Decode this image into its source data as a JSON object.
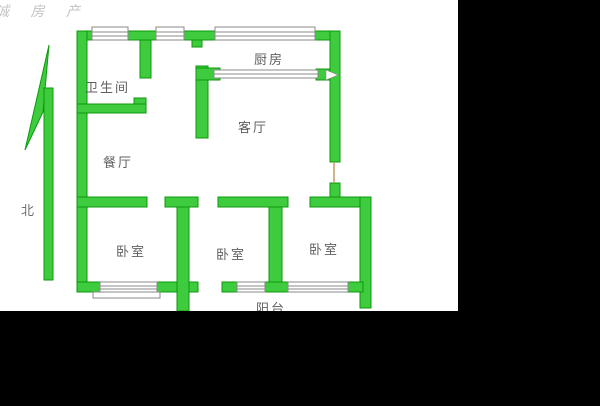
{
  "watermark": {
    "text": "诚 房 产"
  },
  "compass": {
    "label": "北"
  },
  "rooms": {
    "bathroom": "卫生间",
    "kitchen": "厨房",
    "living": "客厅",
    "dining": "餐厅",
    "bedroom1": "卧室",
    "bedroom2": "卧室",
    "bedroom3": "卧室",
    "balcony": "阳台"
  },
  "colors": {
    "wall_fill": "#3ecb3e",
    "wall_stroke": "#0c9a0c",
    "window_stroke": "#8a8a8a",
    "door_jamb": "#c49a6c",
    "label_text": "#5f5f5f",
    "watermark_text": "#c3c3c3",
    "photo_background": "#ffffff",
    "canvas_background": "#000000"
  }
}
